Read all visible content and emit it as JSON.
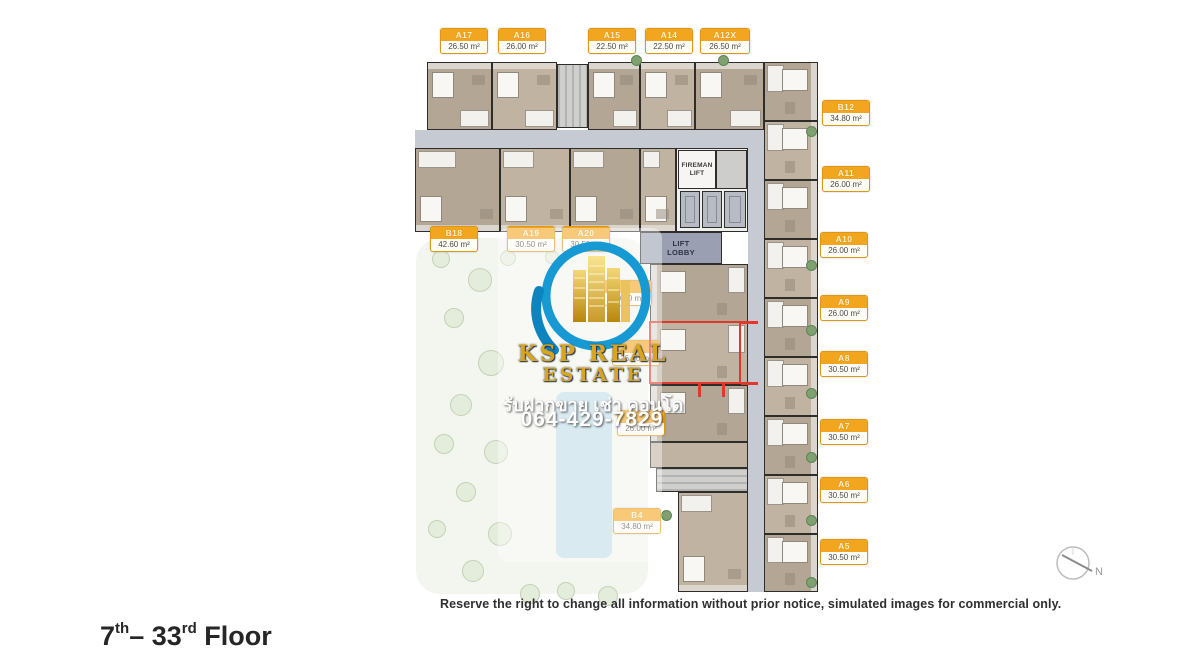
{
  "floor_title": {
    "num1": "7",
    "sup1": "th",
    "dash": "– ",
    "num2": "33",
    "sup2": "rd",
    "rest": " Floor"
  },
  "disclaimer": "Reserve the right to change all information without prior notice, simulated images for commercial only.",
  "compass": {
    "north_label": "N"
  },
  "core": {
    "fireman_lift": "FIREMAN LIFT",
    "lift_lobby": "LIFT LOBBY"
  },
  "watermark": {
    "brand_line1": "KSP REAL",
    "brand_line2": "ESTATE",
    "thai_line": "รับฝากขาย เช่า คอนโด",
    "phone": "064-429-7829",
    "brand_color": "#D8A51D",
    "swoosh_color": "#1799D4",
    "building_gold": "#E9C35C"
  },
  "label_style": {
    "header_color": "#F2A51F",
    "body_color": "#FDFCF5",
    "border_color": "#DE9714"
  },
  "unit_labels": [
    {
      "name": "A17",
      "area": "26.50 m²",
      "x": 440,
      "y": 28
    },
    {
      "name": "A16",
      "area": "26.00 m²",
      "x": 498,
      "y": 28
    },
    {
      "name": "A15",
      "area": "22.50 m²",
      "x": 588,
      "y": 28
    },
    {
      "name": "A14",
      "area": "22.50 m²",
      "x": 645,
      "y": 28
    },
    {
      "name": "A12X",
      "area": "26.50 m²",
      "x": 700,
      "y": 28
    },
    {
      "name": "B12",
      "area": "34.80 m²",
      "x": 822,
      "y": 100
    },
    {
      "name": "A11",
      "area": "26.00 m²",
      "x": 822,
      "y": 166
    },
    {
      "name": "A10",
      "area": "26.00 m²",
      "x": 820,
      "y": 232
    },
    {
      "name": "A9",
      "area": "26.00 m²",
      "x": 820,
      "y": 295
    },
    {
      "name": "A8",
      "area": "30.50 m²",
      "x": 820,
      "y": 351
    },
    {
      "name": "A7",
      "area": "30.50 m²",
      "x": 820,
      "y": 419
    },
    {
      "name": "A6",
      "area": "30.50 m²",
      "x": 820,
      "y": 477
    },
    {
      "name": "A5",
      "area": "30.50 m²",
      "x": 820,
      "y": 539
    },
    {
      "name": "B18",
      "area": "42.60 m²",
      "x": 430,
      "y": 226
    },
    {
      "name": "A19",
      "area": "30.50 m²",
      "x": 507,
      "y": 226
    },
    {
      "name": "A20",
      "area": "30.50 m²",
      "x": 562,
      "y": 226
    },
    {
      "name": "",
      "area": "30.50 m²",
      "x": 604,
      "y": 280
    },
    {
      "name": "",
      "area": "26.00 m²",
      "x": 612,
      "y": 340
    },
    {
      "name": "",
      "area": "26.00 m²",
      "x": 617,
      "y": 410
    },
    {
      "name": "B4",
      "area": "34.80 m²",
      "x": 613,
      "y": 508
    }
  ]
}
